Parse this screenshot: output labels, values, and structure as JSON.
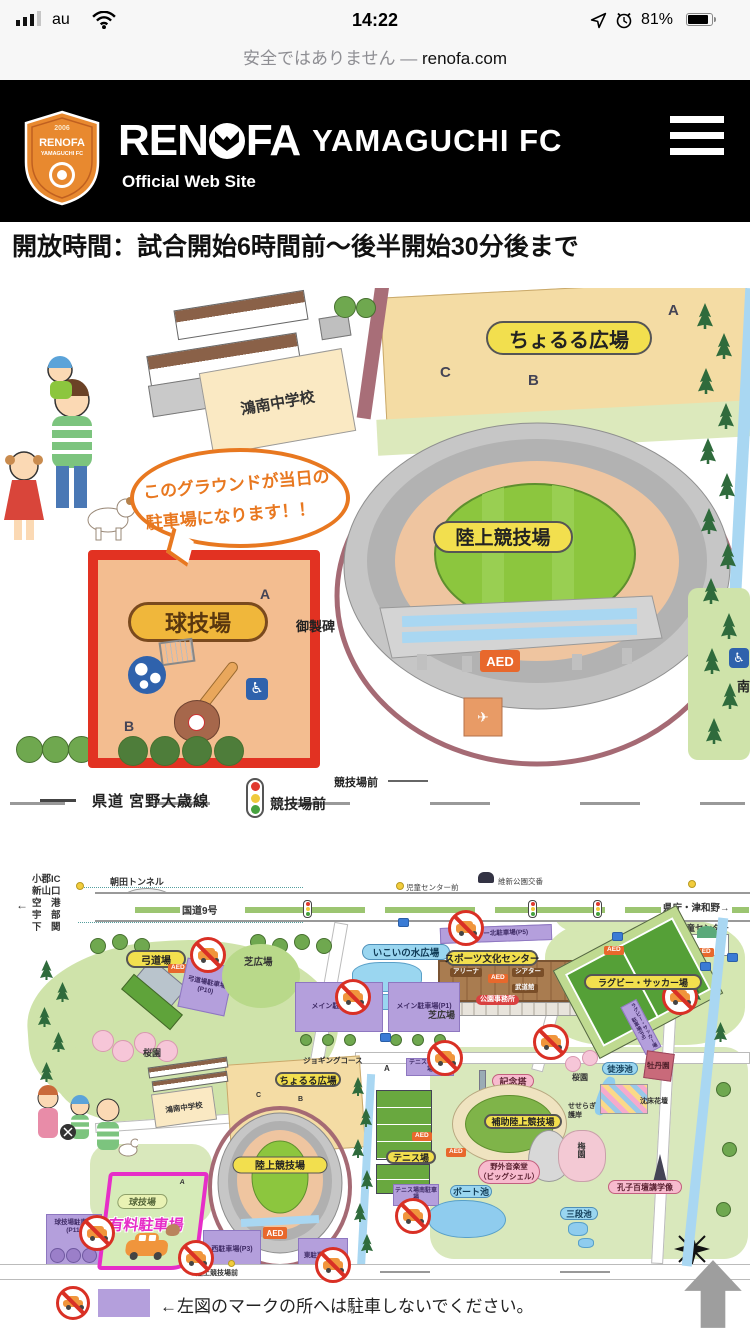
{
  "status_bar": {
    "carrier": "au",
    "time": "14:22",
    "battery_percent": "81%"
  },
  "url_bar": {
    "security_text": "安全ではありません",
    "separator": "—",
    "domain": "renofa.com"
  },
  "header": {
    "crest_year": "2006",
    "crest_line1": "RENOFA",
    "crest_line2": "YAMAGUCHI FC",
    "wordmark_left": "REN",
    "wordmark_right": "FA",
    "wordmark_rest": "YAMAGUCHI FC",
    "tagline": "Official Web Site"
  },
  "content": {
    "heading": "開放時間：試合開始6時間前〜後半開始30分後まで"
  },
  "letters": {
    "a": "A",
    "b": "B",
    "c": "C"
  },
  "map1": {
    "school": "鴻南中学校",
    "choruru_plaza": "ちょるる広場",
    "athletics_stadium": "陸上競技場",
    "ball_field": "球技場",
    "monument": "御製碑",
    "aed": "AED",
    "bubble_line1": "このグラウンドが当日の",
    "bubble_line2": "駐車場になります！！",
    "road_name": "県道 宮野大歳線",
    "signal_name": "競技場前",
    "stop_name": "競技場前",
    "south": "南"
  },
  "map2": {
    "tunnel": "朝田トンネル",
    "dest_arrow": "←",
    "destinations": [
      "小郡IC",
      "新山口",
      "空　港",
      "宇　部",
      "下　関"
    ],
    "route": "国道9号",
    "to_right": "県庁・津和野→",
    "koban": "維新公園交番",
    "bus_stop_left": "児童センター前",
    "kyudojo": "弓道場",
    "kyudo_parking": "弓道場駐車場(P10)",
    "shiba_hill": "芝広場",
    "sakura_garden": "桜園",
    "jido_center": "児童センター",
    "center_north_parking": "センター北駐車場(P5)",
    "ikoi_water_plaza": "いこいの水広場",
    "sports_center": "スポーツ文化センター",
    "arena": "アリーナ",
    "theater": "シアター",
    "budokan": "武道館",
    "park_office": "公園事務所",
    "shiba_plaza": "芝広場",
    "main_parking_p2": "メイン駐車場(P2)",
    "main_parking_p1": "メイン駐車場(P1)",
    "rugby_soccer_field": "ラグビー・サッカー場",
    "rugby_parking": "ラグビー・サッカー場駐車場(P6)",
    "jogging_course": "ジョギングコース",
    "choruru_plaza": "ちょるる広場",
    "konan_school": "鴻南中学校",
    "athletics_stadium": "陸上競技場",
    "athletics_front": "陸上競技場前",
    "ball_field": "球技場",
    "paid_parking": "有料駐車場",
    "ball_field_parking": "球技場駐車場(P11)",
    "west_parking": "西駐車場(P3)",
    "east_parking": "東駐車場(P4)",
    "tennis_north_parking": "テニス場北駐車場",
    "tennis_south_parking": "テニス場南駐車場",
    "tennis_courts": "テニス場",
    "memorial_tower": "記念塔",
    "aux_athletics": "補助陸上競技場",
    "music_hall_1": "野外音楽堂",
    "music_hall_2": "（ビッグシェル）",
    "boat_pond": "ボート池",
    "sandan_pond": "三段池",
    "wading_pond": "徒渉池",
    "botan_garden": "牡丹園",
    "sunken_garden": "沈床花壇",
    "seseragi_1": "せせらぎ",
    "seseragi_2": "護岸",
    "ume_garden": "梅園",
    "confucius_statue": "孔子百壇講学像",
    "aed": "AED"
  },
  "legend": {
    "text": "←左図のマークの所へは駐車しないでください。"
  }
}
